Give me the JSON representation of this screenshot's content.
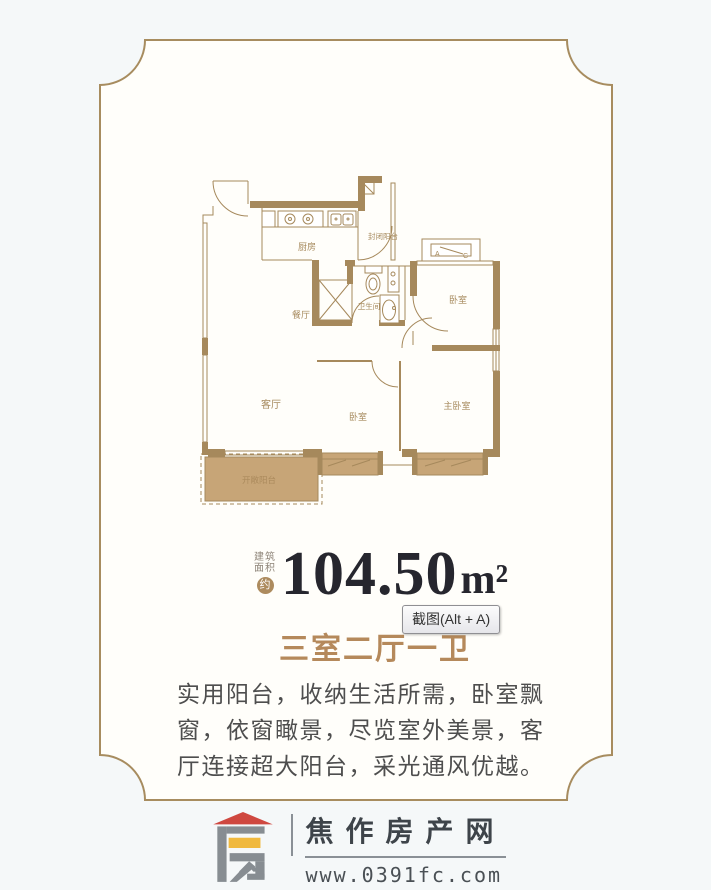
{
  "page": {
    "bg": "#f5f8f9",
    "panel_bg": "#fffefa"
  },
  "frame": {
    "border_color": "#a78c5f"
  },
  "floor_plan": {
    "wall_color": "#a6895c",
    "balcony_fill": "#c7a577",
    "labels": {
      "kitchen": "厨房",
      "enclosed_balcony": "封闭阳台",
      "dining": "餐厅",
      "bathroom": "卫生间",
      "bedroom_top": "卧室",
      "living_room": "客厅",
      "bedroom_mid": "卧室",
      "master_bedroom": "主卧室",
      "open_balcony": "开敞阳台"
    },
    "ac_unit": {
      "a": "A",
      "c": "C"
    }
  },
  "area": {
    "prefix_line1": "建筑",
    "prefix_line2": "面积",
    "approx_badge": "约",
    "value": "104.50",
    "unit": "m²",
    "value_color": "#26262e"
  },
  "tooltip": {
    "label": "截图(Alt + A)"
  },
  "layout_title": {
    "text": "三室二厅一卫",
    "color": "#b5895b"
  },
  "description": {
    "line1": "实用阳台，收纳生活所需，卧室飘",
    "line2": "窗，依窗瞰景，尽览室外美景，客",
    "line3": "厅连接超大阳台，采光通风优越。"
  },
  "footer": {
    "site_name": "焦作房产网",
    "site_url": "www.0391fc.com",
    "logo_colors": {
      "red": "#cf4840",
      "yellow": "#f0b93e",
      "gray": "#878d92"
    }
  }
}
